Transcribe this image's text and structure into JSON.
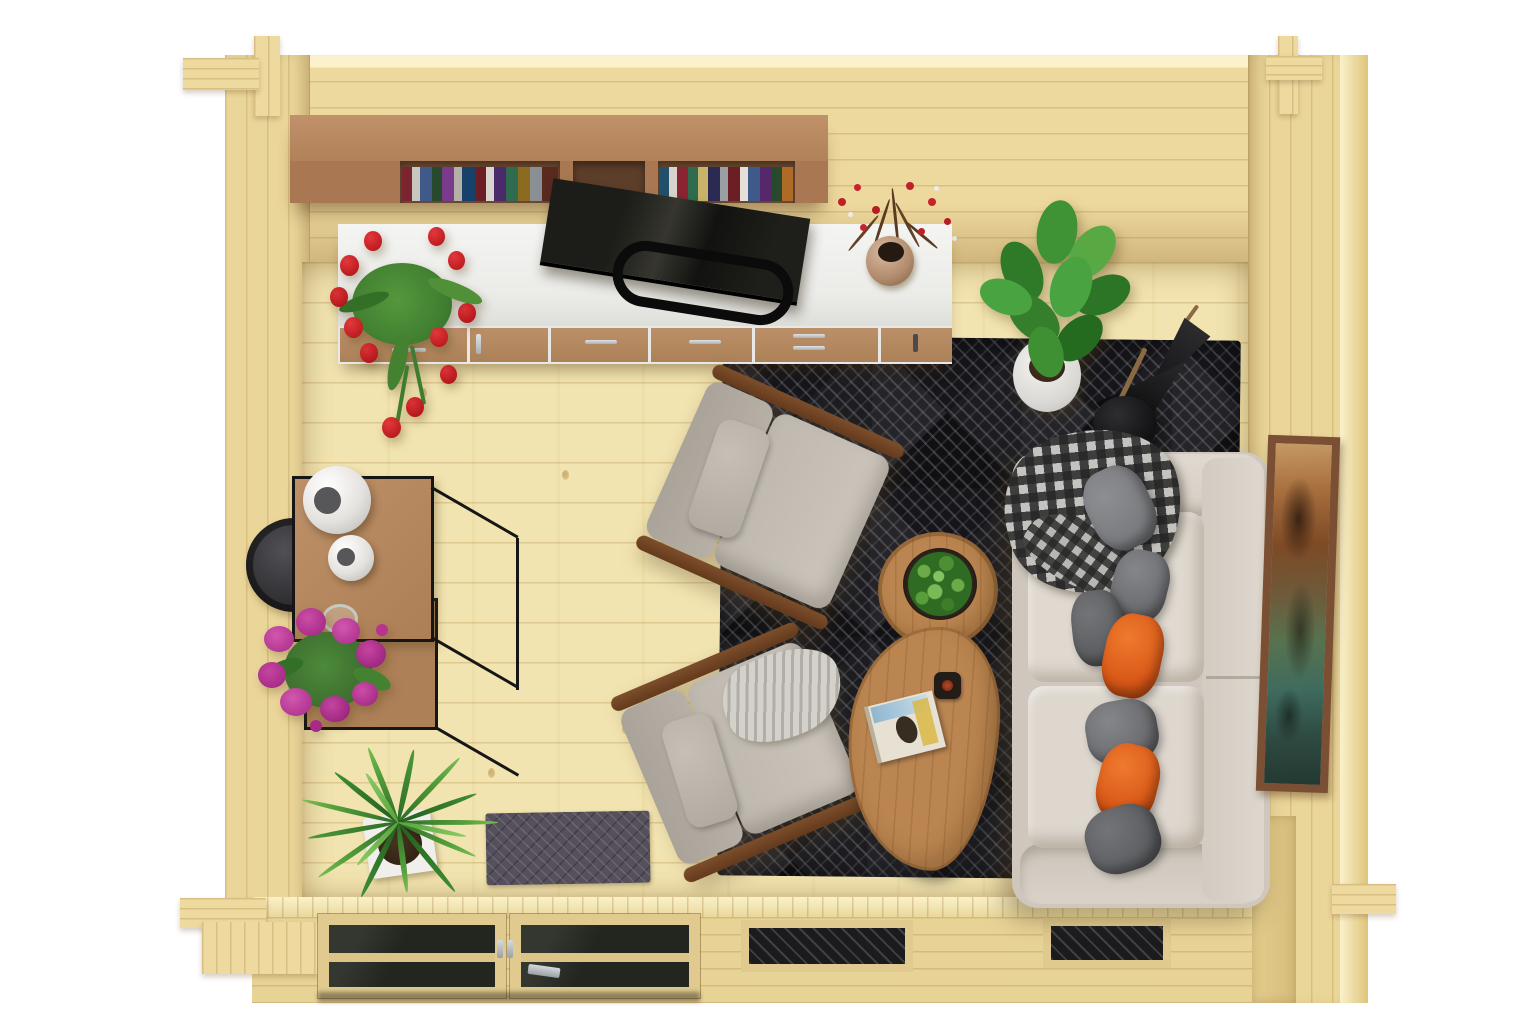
{
  "scene": {
    "title": "Top-down 3D render of a log cabin garden room with lounge furniture",
    "style": "bird's-eye architectural interior render on white background"
  },
  "palette": {
    "background": "#ffffff",
    "floor_pine": "#f2e4b0",
    "wall_pine": "#edd89d",
    "shelf_wood": "#a97852",
    "sideboard_top": "#f1f1ef",
    "drawer_wood": "#b48a66",
    "tv_black": "#151513",
    "rug_base": "#141417",
    "rug_lines": "#97979b",
    "sofa_beige": "#d9d2c9",
    "pillow_grey": "#6b6c6f",
    "pillow_orange": "#d85716",
    "armchair_grey": "#c7c1b8",
    "chair_wood": "#7c4e2b",
    "table_wood": "#ba8550",
    "leaf_green": "#3f7d2c",
    "tulip_red": "#c0181c",
    "berry_red": "#bf2028",
    "purple_flower": "#b8338f",
    "doormat": "#55505c",
    "frame_brown": "#7a4f33",
    "metal_black": "#161616"
  },
  "objects": {
    "room": {
      "label": "Log cabin room seen from above"
    },
    "top_wall": {
      "label": "Rear log wall"
    },
    "left_wall": {
      "label": "Left log wall"
    },
    "right_wall": {
      "label": "Right log wall"
    },
    "front_wall": {
      "label": "Front wall with glazed double door and two windows"
    },
    "floor": {
      "label": "Pine plank floor"
    },
    "bookshelf": {
      "label": "Wall-mounted wooden shelf with books"
    },
    "sideboard": {
      "label": "White media sideboard with wooden drawers"
    },
    "tv": {
      "label": "Flat screen TV leaning on the sideboard"
    },
    "tulips": {
      "label": "Red tulips in a pot on the sideboard"
    },
    "berry_vase": {
      "label": "Vase with red berry branches"
    },
    "ficus": {
      "label": "Potted green ficus plant"
    },
    "umbrella": {
      "label": "Dark umbrella leaning in the corner"
    },
    "floor_lamp": {
      "label": "Black floor lamp"
    },
    "rug": {
      "label": "Dark geometric patterned area rug"
    },
    "armchair_top": {
      "label": "Grey fabric armchair with wooden frame"
    },
    "armchair_bottom": {
      "label": "Grey fabric armchair with herringbone throw"
    },
    "throw": {
      "label": "Light herringbone throw blanket"
    },
    "coffee_table_round": {
      "label": "Round wooden coffee table"
    },
    "coffee_table_kidney": {
      "label": "Kidney-shaped wooden coffee table"
    },
    "plant_bowl": {
      "label": "Bowl with green plant on round table"
    },
    "candle": {
      "label": "Small candle on coffee table"
    },
    "book": {
      "label": "Book lying on coffee table"
    },
    "sofa": {
      "label": "Beige three-seat sofa against right wall"
    },
    "blanket": {
      "label": "Grey checkered blanket draped over sofa arm"
    },
    "pillows": {
      "label": "Grey and orange scatter cushions"
    },
    "picture": {
      "label": "Framed artwork on right wall"
    },
    "shelf_unit": {
      "label": "Black metal frame shelf unit with wooden boards"
    },
    "vase_large": {
      "label": "Large white sphere vase"
    },
    "vase_small": {
      "label": "Small white sphere vase"
    },
    "glass_bowl": {
      "label": "Glass bowl on lower shelf"
    },
    "side_table": {
      "label": "Round dark side table"
    },
    "purple_plant": {
      "label": "Purple flowering potted plant"
    },
    "palm": {
      "label": "Palm plant in white square pot"
    },
    "doormat": {
      "label": "Dark grey doormat at the door"
    },
    "door": {
      "label": "Glazed wooden double door"
    },
    "window_left": {
      "label": "Front window opening"
    },
    "window_right": {
      "label": "Front window opening"
    },
    "porch_step": {
      "label": "Wooden entrance step"
    }
  }
}
